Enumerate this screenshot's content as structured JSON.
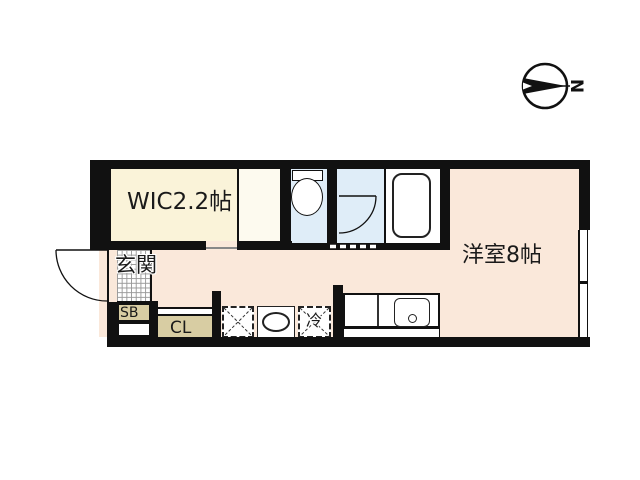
{
  "title": "apartment floor plan",
  "compass": {
    "north_label": "N"
  },
  "labels": {
    "wic": "WIC2.2帖",
    "main_room": "洋室8帖",
    "entrance": "玄関",
    "shoe_box": "SB",
    "closet": "CL",
    "refrigerator": "冷"
  },
  "colors": {
    "wic_floor": "#faf3d9",
    "wic_closet_floor": "#fdfaef",
    "main_floor": "#fae8da",
    "wet_area_floor": "#dfedf8",
    "storage_fill": "#d8cda3",
    "wall": "#111111"
  }
}
